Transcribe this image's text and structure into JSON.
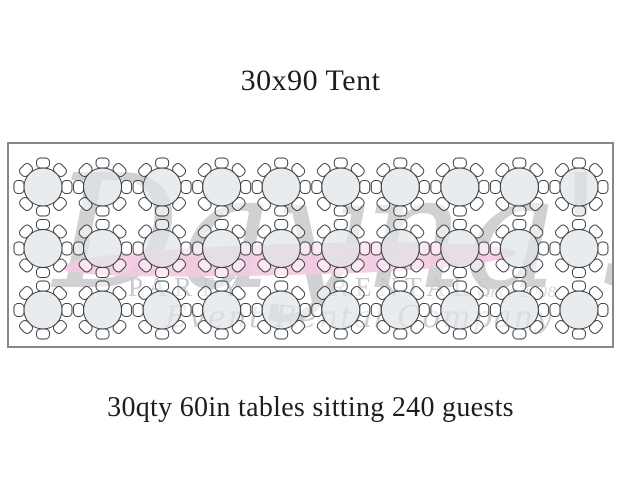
{
  "title": "30x90 Tent",
  "caption": "30qty 60in tables sitting 240 guests",
  "watermark": {
    "script_name": "Dayna's",
    "word_left": "PARTY",
    "word_right": "RENTALS",
    "since": "since 2008",
    "tagline": "Event Rental Company",
    "pink_color": "#f3c9e0",
    "gray_color": "#9a9da1"
  },
  "diagram": {
    "tent_label": "30x90 Tent",
    "rows": 3,
    "cols": 10,
    "tables_total": 30,
    "seats_per_table": 8,
    "guests_total": 240,
    "table_fill": "#dfe4e9",
    "table_fill_alpha": 0.72,
    "chair_fill": "#ffffff",
    "chair_fill_alpha": 0.55,
    "outline_color": "#3f4042",
    "tent_border_color": "#85878a"
  }
}
